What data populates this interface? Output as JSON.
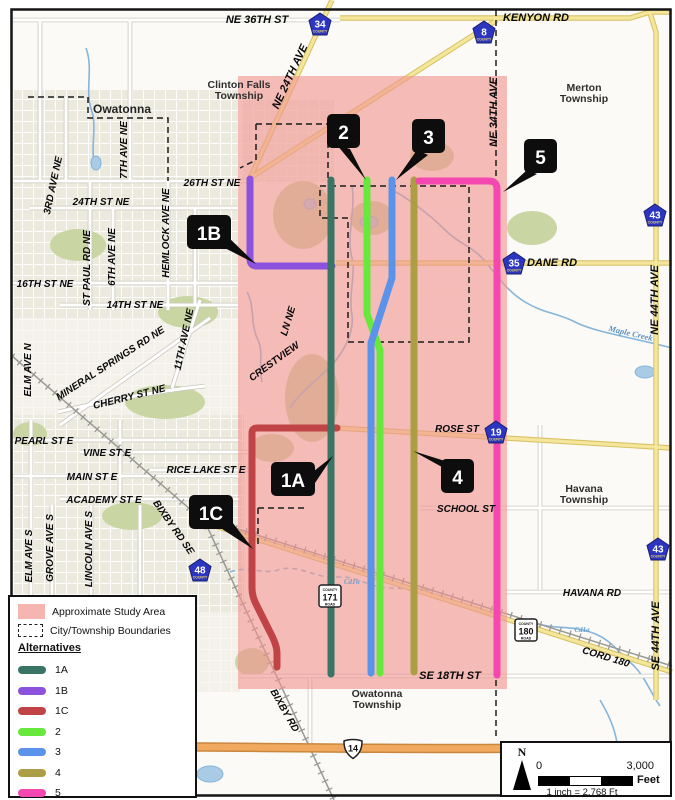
{
  "legend": {
    "study_area_label": "Approximate Study Area",
    "boundaries_label": "City/Township Boundaries",
    "alternatives_heading": "Alternatives",
    "study_area_color": "#f5b6b2",
    "study_area_overlay_rgba": "rgba(240,148,144,0.62)",
    "alternatives": [
      {
        "id": "1A",
        "color": "#3a7465"
      },
      {
        "id": "1B",
        "color": "#8a52dd"
      },
      {
        "id": "1C",
        "color": "#c04446"
      },
      {
        "id": "2",
        "color": "#66e93c"
      },
      {
        "id": "3",
        "color": "#5b93ea"
      },
      {
        "id": "4",
        "color": "#ac9e45"
      },
      {
        "id": "5",
        "color": "#f448b0"
      }
    ]
  },
  "scale_bar": {
    "north_label": "N",
    "start": "0",
    "end": "3,000",
    "unit": "Feet",
    "ratio": "1 inch = 2,768 Ft"
  },
  "callouts": {
    "c1a": "1A",
    "c1b": "1B",
    "c1c": "1C",
    "c2": "2",
    "c3": "3",
    "c4": "4",
    "c5": "5"
  },
  "shields": {
    "county34": "34",
    "county8": "8",
    "county43_north": "43",
    "county35": "35",
    "county19": "19",
    "county43_south": "43",
    "county48": "48",
    "county171": "171",
    "county180": "180",
    "us14": "14",
    "county_caption": "COUNTY",
    "road_caption": "ROAD"
  },
  "townships": {
    "clinton_falls_1": "Clinton Falls",
    "clinton_falls_2": "Township",
    "merton_1": "Merton",
    "merton_2": "Township",
    "owatonna_city": "Owatonna",
    "havana_1": "Havana",
    "havana_2": "Township",
    "owatonna_twp_1": "Owatonna",
    "owatonna_twp_2": "Township"
  },
  "streets": {
    "ne_36th_st": "NE 36TH ST",
    "kenyon_rd": "KENYON RD",
    "ne_24th_ave": "NE 24TH AVE",
    "ne_34th_ave": "NE 34TH AVE",
    "ne_44th_ave": "NE 44TH AVE",
    "se_44th_ave": "SE 44TH AVE",
    "st_26th_ne": "26TH ST NE",
    "st_24th_ne": "24TH ST NE",
    "ave_3rd_ne": "3RD AVE NE",
    "ave_7th_ne": "7TH AVE NE",
    "st_paul_rd_ne": "ST PAUL RD NE",
    "ave_6th_ne": "6TH AVE NE",
    "hemlock_ave_ne": "HEMLOCK AVE NE",
    "st_16th_ne": "16TH ST NE",
    "st_14th_ne": "14TH ST NE",
    "ave_11th_ne": "11TH AVE NE",
    "mineral_springs": "MINERAL SPRINGS RD NE",
    "cherry_st_ne": "CHERRY ST NE",
    "elm_ave_n": "ELM AVE N",
    "pearl_st_e": "PEARL ST E",
    "vine_st_e": "VINE ST E",
    "main_st_e": "MAIN ST E",
    "rice_lake_st_e": "RICE LAKE ST E",
    "academy_st_e": "ACADEMY ST E",
    "elm_ave_s": "ELM AVE S",
    "grove_ave_s": "GROVE AVE S",
    "lincoln_ave_s": "LINCOLN AVE S",
    "bixby_rd_se": "BIXBY RD SE",
    "bixby_rd": "BIXBY RD",
    "crestview": "CRESTVIEW",
    "ln_ne": "LN NE",
    "dane_rd": "DANE RD",
    "rose_st": "ROSE ST",
    "school_st": "SCHOOL ST",
    "havana_rd": "HAVANA RD",
    "se_18th_st": "SE 18TH ST",
    "cord_180": "CORD 180"
  },
  "water": {
    "maple_creek": "Maple Creek",
    "cd1w": "Cd1w",
    "cd1a": "Cd1a"
  }
}
